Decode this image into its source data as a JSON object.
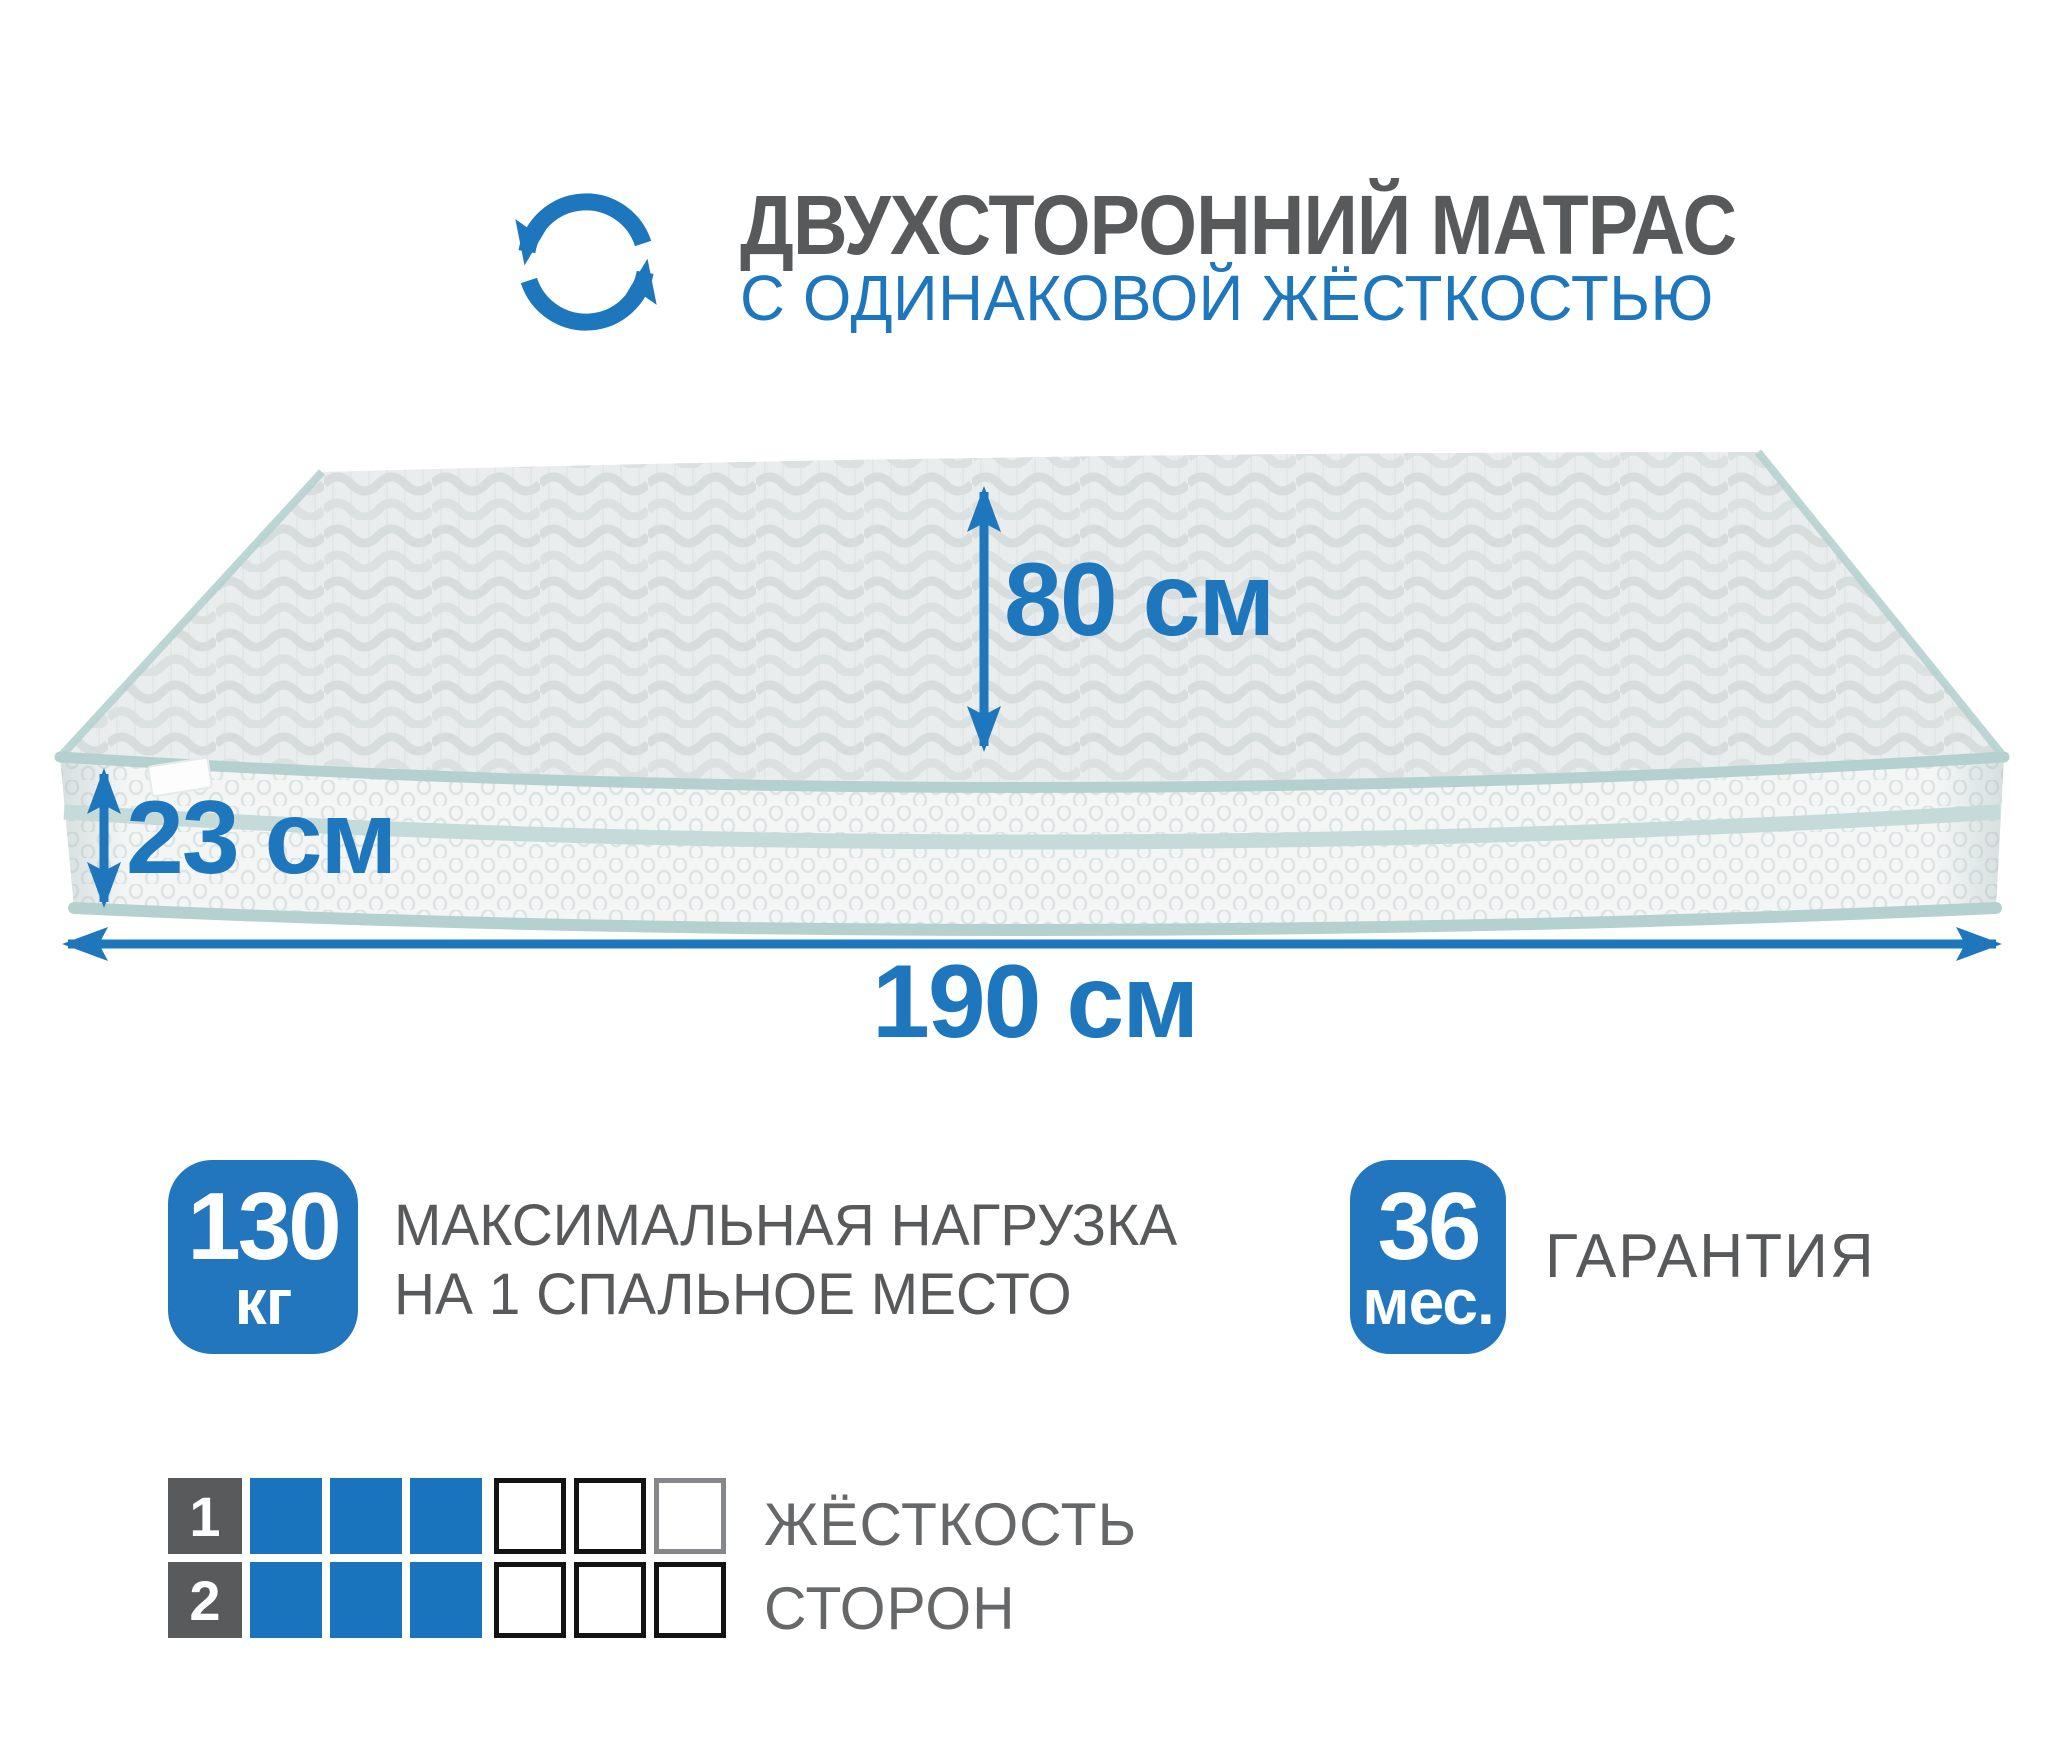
{
  "header": {
    "title": "ДВУХСТОРОННИЙ МАТРАС",
    "subtitle": "С ОДИНАКОВОЙ ЖЁСТКОСТЬЮ",
    "icon": "rotate-arrows-icon"
  },
  "mattress": {
    "top_width_label": "80 см",
    "side_height_label": "23 см",
    "length_label": "190 см"
  },
  "badges": {
    "max_load": {
      "value": "130",
      "unit": "кг",
      "text_line1": "МАКСИМАЛЬНАЯ НАГРУЗКА",
      "text_line2": "НА 1 СПАЛЬНОЕ МЕСТО"
    },
    "warranty": {
      "value": "36",
      "unit": "мес.",
      "text": "ГАРАНТИЯ"
    }
  },
  "firmness": {
    "text_line1": "ЖЁСТКОСТЬ",
    "text_line2": "СТОРОН",
    "scale_total": 6,
    "sides": [
      {
        "number": "1",
        "filled": 3
      },
      {
        "number": "2",
        "filled": 3
      }
    ]
  },
  "colors": {
    "accent_blue": "#1e76bd",
    "badge_blue": "#2176bd",
    "square_blue": "#1a73bd",
    "title_gray": "#58595b",
    "label_gray": "#666769",
    "number_cell_gray": "#595a5c",
    "piping_teal": "#b5d1cf",
    "mattress_top": "#eaeded",
    "mattress_side": "#f4f6f6"
  }
}
